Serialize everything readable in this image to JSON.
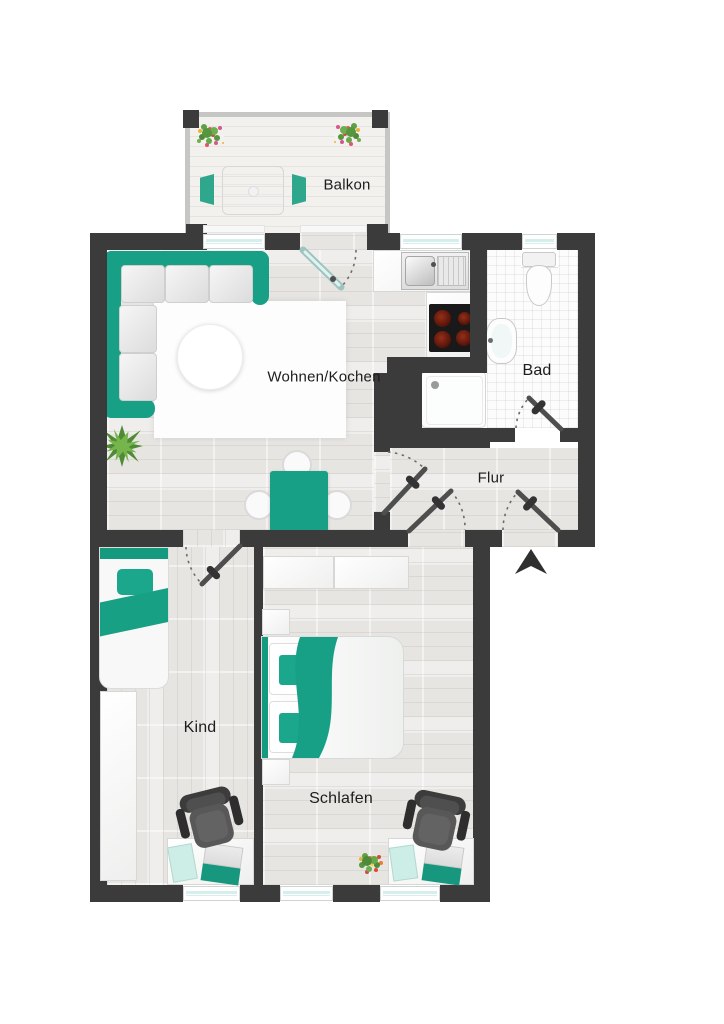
{
  "floorplan": {
    "rooms": [
      {
        "id": "balkon",
        "label": "Balkon"
      },
      {
        "id": "wohnen_kochen",
        "label": "Wohnen/Kochen"
      },
      {
        "id": "bad",
        "label": "Bad"
      },
      {
        "id": "flur",
        "label": "Flur"
      },
      {
        "id": "kind",
        "label": "Kind"
      },
      {
        "id": "schlafen",
        "label": "Schlafen"
      }
    ],
    "colors": {
      "wall": "#3b3b3b",
      "accent_teal": "#18a086",
      "wood_floor": "#e7e5e2",
      "tile_floor": "#fcfcfc",
      "window_glass": "#d6efec",
      "chair_dark": "#4f4f4f"
    },
    "symbols": [
      "entrance-arrow",
      "door-swing",
      "window",
      "corner-sofa",
      "rug",
      "coffee-table",
      "potted-plant",
      "dining-table",
      "dining-chair",
      "kitchen-sink",
      "stove",
      "shower",
      "toilet",
      "washbasin",
      "single-bed",
      "double-bed",
      "wardrobe",
      "nightstand",
      "desk",
      "office-chair",
      "laptop",
      "notepad",
      "flower-box",
      "balcony-table",
      "balcony-chair"
    ]
  }
}
